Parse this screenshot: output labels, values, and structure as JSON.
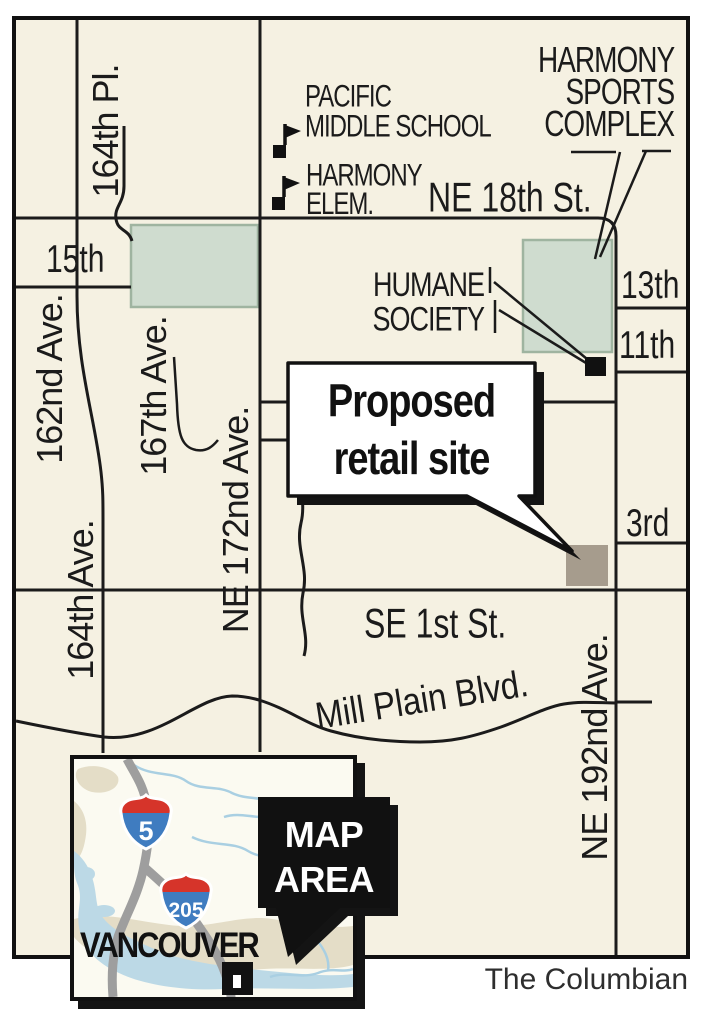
{
  "credit": "The Columbian",
  "streets": {
    "pl_164th": "164th Pl.",
    "st_15th": "15th",
    "ave_162nd": "162nd Ave.",
    "ave_167th": "167th Ave.",
    "ave_172nd": "NE 172nd Ave.",
    "ave_164th": "164th Ave.",
    "st_ne18th": "NE 18th St.",
    "st_13th": "13th",
    "st_11th": "11th",
    "st_3rd": "3rd",
    "st_se1st": "SE 1st St.",
    "blvd_millplain": "Mill Plain Blvd.",
    "ave_192nd": "NE 192nd Ave."
  },
  "pois": {
    "pacific": [
      "PACIFIC",
      "MIDDLE SCHOOL"
    ],
    "harmony_elem": [
      "HARMONY",
      "ELEM."
    ],
    "sports_complex": [
      "HARMONY",
      "SPORTS",
      "COMPLEX"
    ],
    "humane_society": [
      "HUMANE",
      "SOCIETY"
    ]
  },
  "callout": {
    "line1": "Proposed",
    "line2": "retail site"
  },
  "inset": {
    "map_area": [
      "MAP",
      "AREA"
    ],
    "city": "VANCOUVER",
    "interstate_5": "5",
    "interstate_205": "205"
  },
  "colors": {
    "map_background": "#f5f1e2",
    "road": "#1b1b1b",
    "park_fill": "#cfdccf",
    "park_stroke": "#9fb4a0",
    "site_fill": "#a69c8d",
    "marker_black": "#111111",
    "callout_fill": "#ffffff",
    "shield_red": "#d6342a",
    "shield_blue": "#3f7cc0",
    "inset_water": "#bcd9e6",
    "inset_land": "#e4ddc7",
    "inset_highway": "#9e9e9e"
  }
}
